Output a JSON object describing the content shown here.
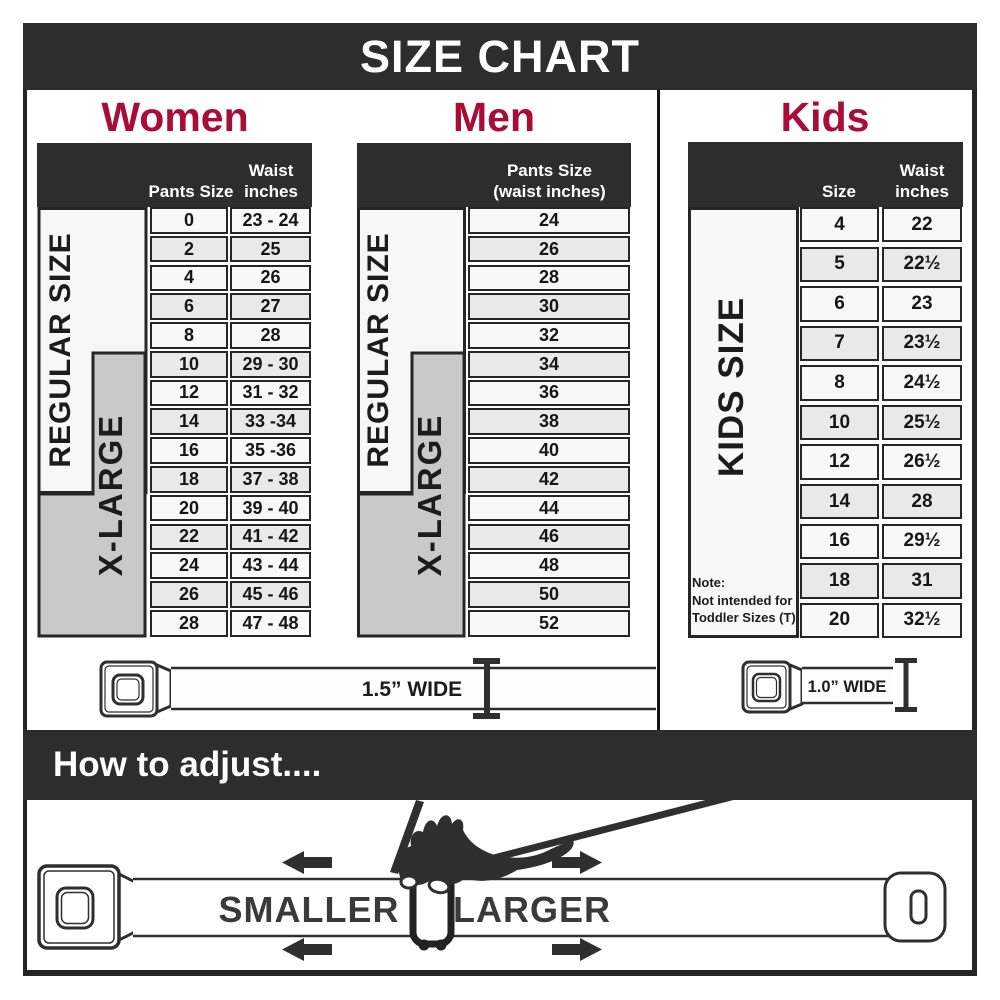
{
  "title": "SIZE CHART",
  "colors": {
    "dark": "#2d2d2d",
    "crimson": "#a90d37",
    "label_gray": "#c9c9c9",
    "row_alt": "#e9e9e9",
    "border": "#262626"
  },
  "women": {
    "heading": "Women",
    "header": {
      "col1": "Pants Size",
      "col2_line1": "Waist",
      "col2_line2": "inches"
    },
    "regular_label": "REGULAR SIZE",
    "xlarge_label": "X-LARGE",
    "rows": [
      {
        "size": "0",
        "waist": "23 - 24"
      },
      {
        "size": "2",
        "waist": "25"
      },
      {
        "size": "4",
        "waist": "26"
      },
      {
        "size": "6",
        "waist": "27"
      },
      {
        "size": "8",
        "waist": "28"
      },
      {
        "size": "10",
        "waist": "29 - 30"
      },
      {
        "size": "12",
        "waist": "31 - 32"
      },
      {
        "size": "14",
        "waist": "33 -34"
      },
      {
        "size": "16",
        "waist": "35 -36"
      },
      {
        "size": "18",
        "waist": "37 - 38"
      },
      {
        "size": "20",
        "waist": "39 - 40"
      },
      {
        "size": "22",
        "waist": "41 - 42"
      },
      {
        "size": "24",
        "waist": "43 - 44"
      },
      {
        "size": "26",
        "waist": "45 - 46"
      },
      {
        "size": "28",
        "waist": "47 - 48"
      }
    ]
  },
  "men": {
    "heading": "Men",
    "header": {
      "line1": "Pants Size",
      "line2": "(waist inches)"
    },
    "regular_label": "REGULAR SIZE",
    "xlarge_label": "X-LARGE",
    "rows": [
      "24",
      "26",
      "28",
      "30",
      "32",
      "34",
      "36",
      "38",
      "40",
      "42",
      "44",
      "46",
      "48",
      "50",
      "52"
    ]
  },
  "kids": {
    "heading": "Kids",
    "header": {
      "col1": "Size",
      "col2_line1": "Waist",
      "col2_line2": "inches"
    },
    "side_label": "KIDS SIZE",
    "note_lines": [
      "Note:",
      "Not intended for",
      "Toddler Sizes (T)"
    ],
    "rows": [
      {
        "size": "4",
        "waist": "22"
      },
      {
        "size": "5",
        "waist": "22½"
      },
      {
        "size": "6",
        "waist": "23"
      },
      {
        "size": "7",
        "waist": "23½"
      },
      {
        "size": "8",
        "waist": "24½"
      },
      {
        "size": "10",
        "waist": "25½"
      },
      {
        "size": "12",
        "waist": "26½"
      },
      {
        "size": "14",
        "waist": "28"
      },
      {
        "size": "16",
        "waist": "29½"
      },
      {
        "size": "18",
        "waist": "31"
      },
      {
        "size": "20",
        "waist": "32½"
      }
    ]
  },
  "belts": {
    "adult_width_label": "1.5” WIDE",
    "kids_width_label": "1.0” WIDE"
  },
  "adjust": {
    "heading": "How to adjust....",
    "smaller_label": "SMALLER",
    "larger_label": "LARGER"
  }
}
